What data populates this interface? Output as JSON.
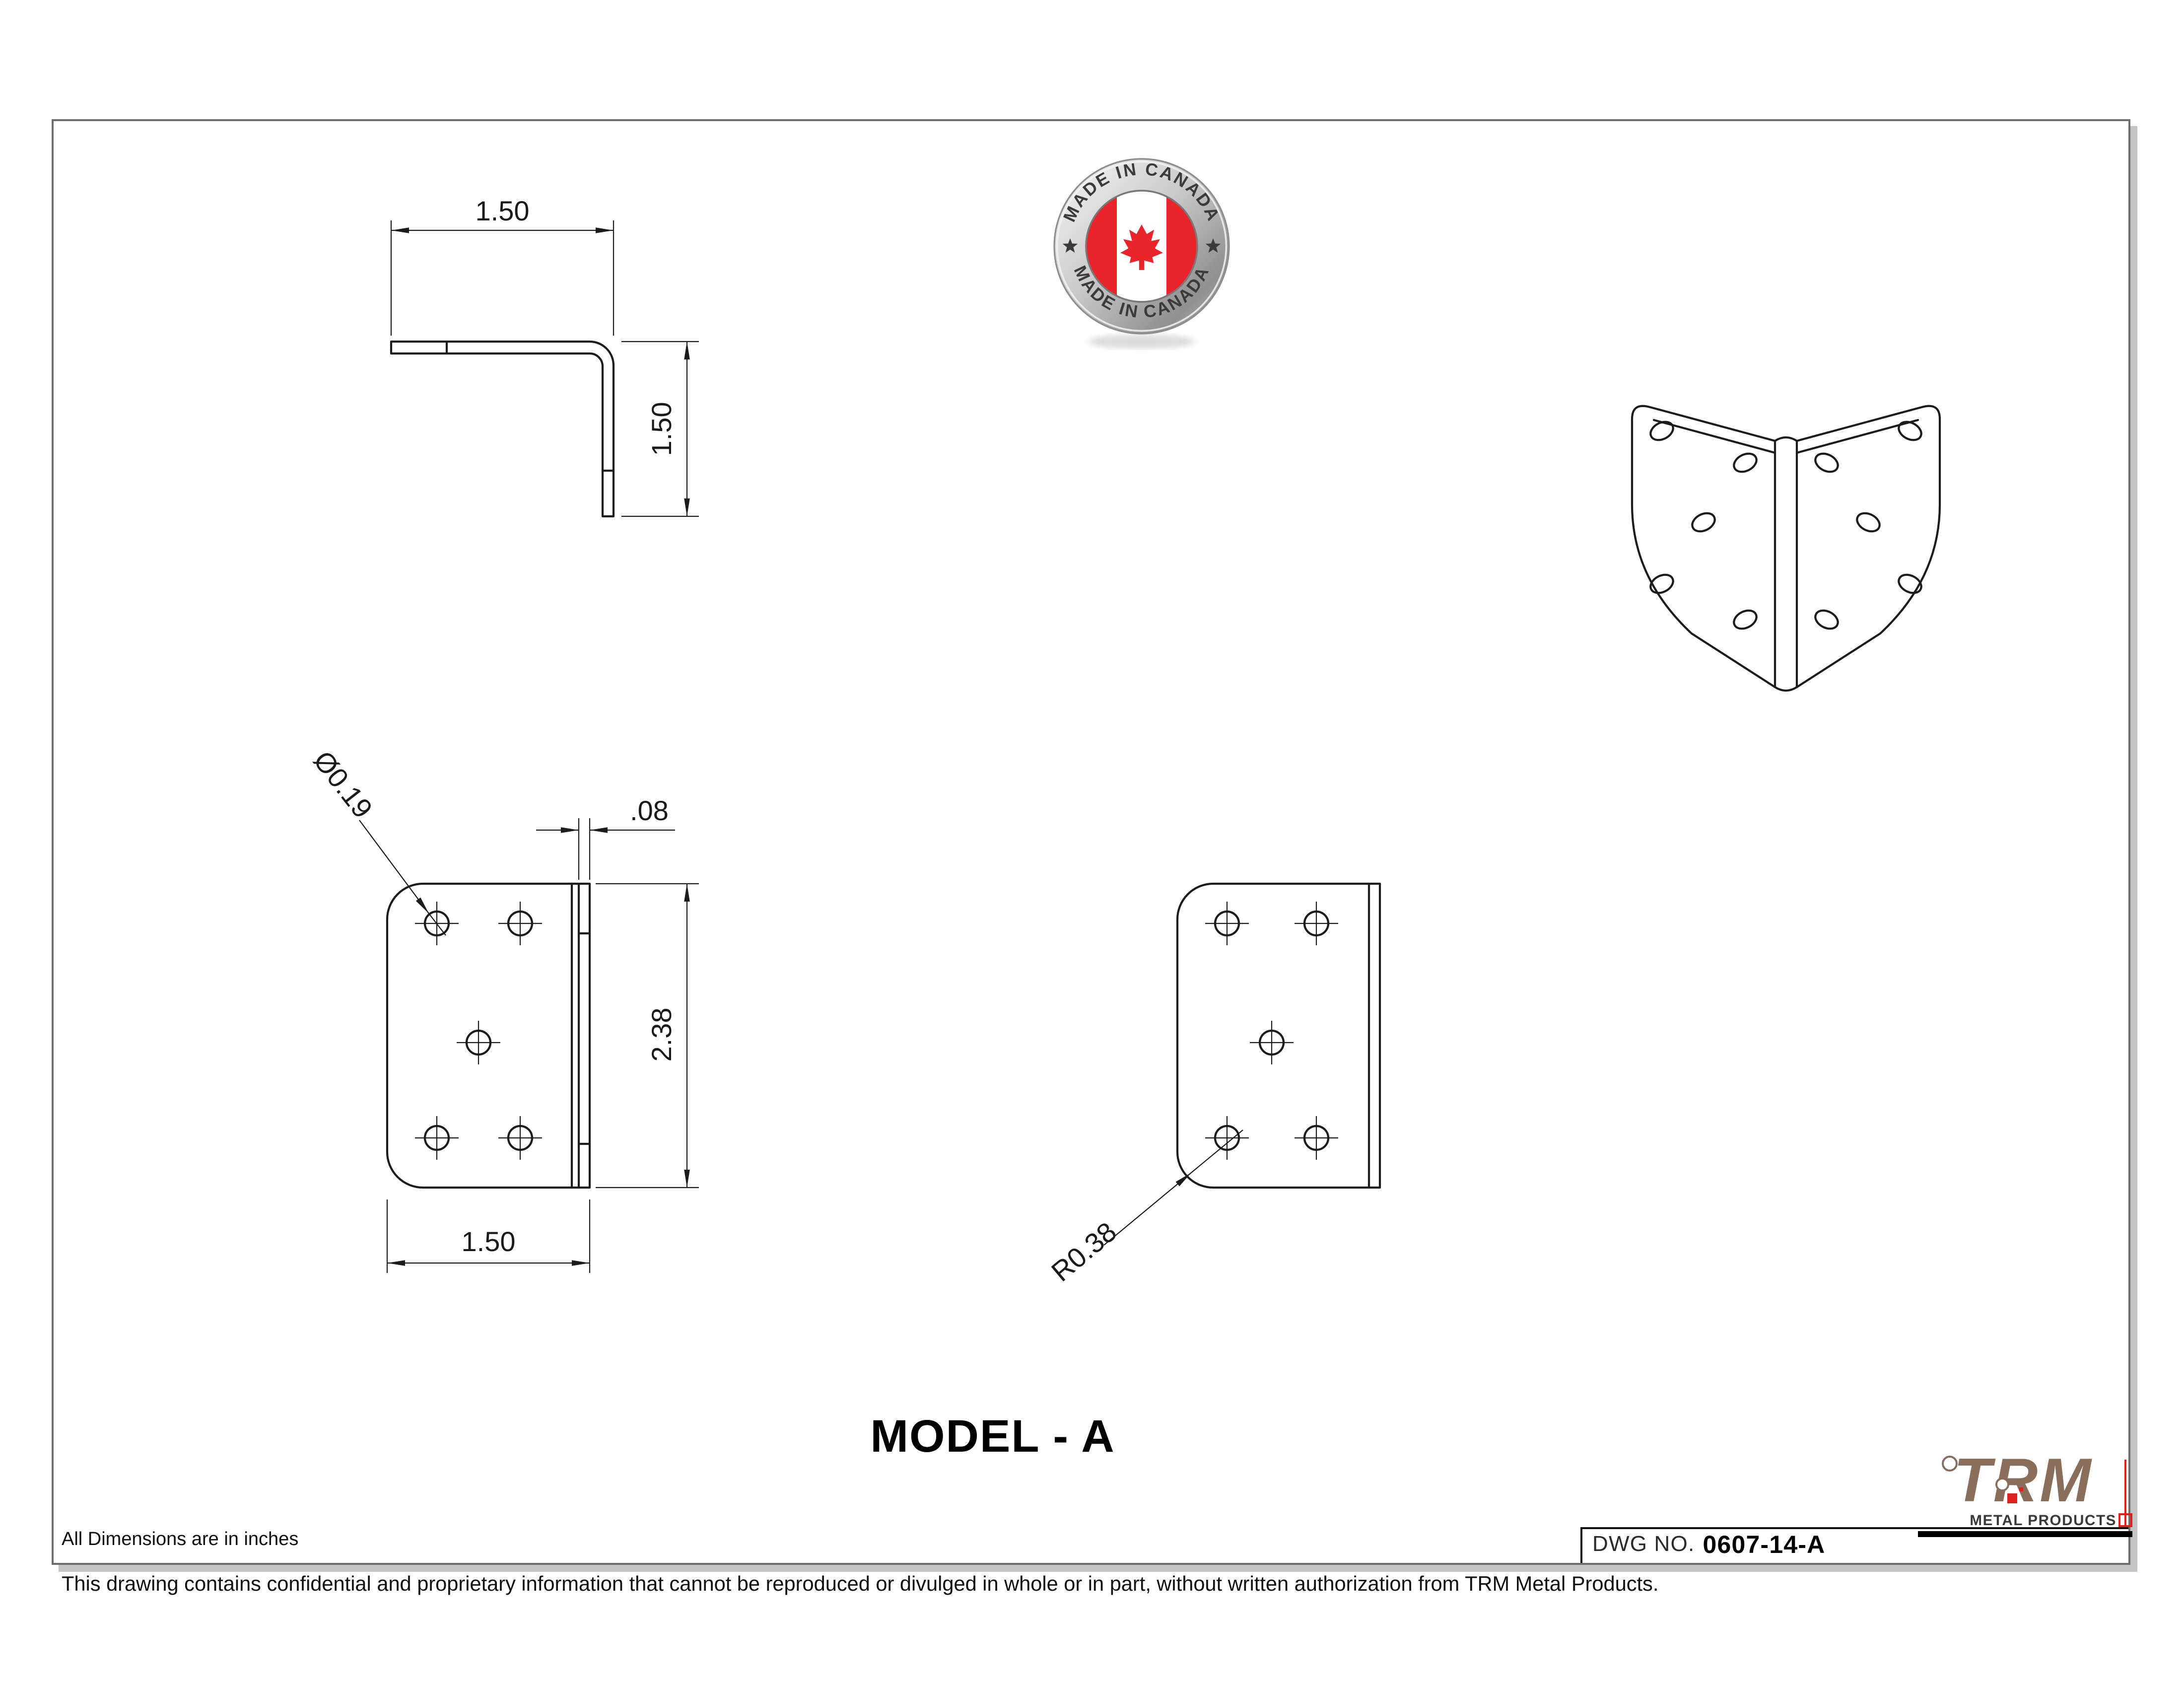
{
  "drawing": {
    "title": "MODEL - A",
    "dwg_label": "DWG NO.",
    "dwg_number": "0607-14-A",
    "units_note": "All Dimensions are in inches",
    "disclaimer": "This drawing contains confidential and proprietary information that cannot be reproduced or divulged in whole or in part, without written authorization from TRM Metal Products."
  },
  "badge": {
    "top_text": "MADE IN CANADA",
    "bottom_text": "MADE IN CANADA"
  },
  "logo": {
    "name": "TRM",
    "tagline": "METAL PRODUCTS"
  },
  "dims": {
    "top_view_width": "1.50",
    "top_view_height": "1.50",
    "hole_diameter": "Ø0.19",
    "thickness": ".08",
    "plate_height": "2.38",
    "plate_width": "1.50",
    "corner_radius": "R0.38"
  },
  "colors": {
    "line": "#1c1c1c",
    "sheet_border": "#6e6e6e",
    "sheet_shadow": "#c4c4c4",
    "logo_brown": "#8a6e5c",
    "logo_red": "#e0201d",
    "flag_red": "#e8252a",
    "badge_text": "#3b3b3b"
  }
}
